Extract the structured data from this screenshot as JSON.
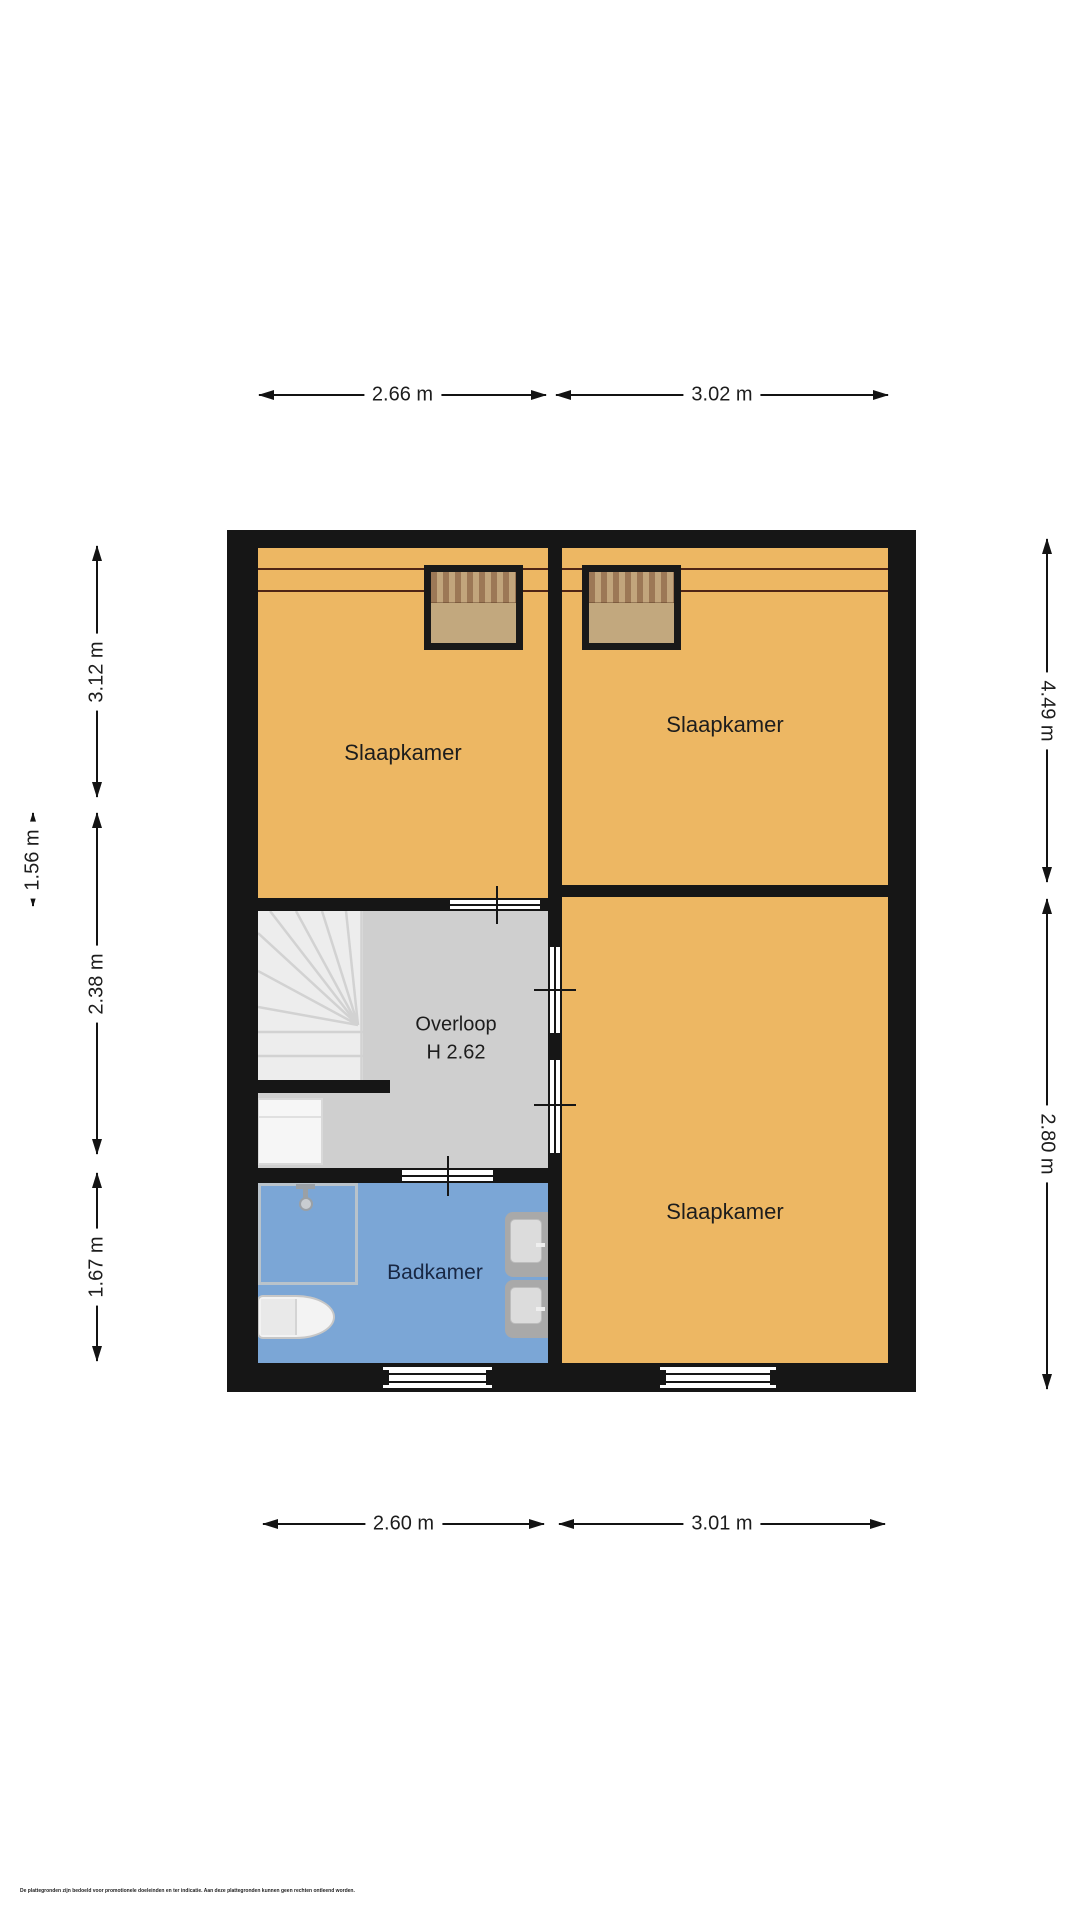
{
  "rooms": {
    "bedroom_top_left": {
      "label": "Slaapkamer"
    },
    "bedroom_right": {
      "label": "Slaapkamer"
    },
    "bedroom_bottom_right": {
      "label": "Slaapkamer"
    },
    "landing": {
      "label": "Overloop",
      "ceiling_height": "H 2.62"
    },
    "bathroom": {
      "label": "Badkamer"
    }
  },
  "dimensions": {
    "top_left": "2.66 m",
    "top_right": "3.02 m",
    "bottom_left": "2.60 m",
    "bottom_right": "3.01 m",
    "left_upper": "3.12 m",
    "left_middle": "2.38 m",
    "left_inner": "1.56 m",
    "left_lower": "1.67 m",
    "right_upper": "4.49 m",
    "right_lower": "2.80 m"
  },
  "footer": {
    "disclaimer": "De plattegronden zijn bedoeld voor promotionele doeleinden en ter indicatie. Aan deze plattegronden kunnen geen rechten ontleend worden."
  },
  "colors": {
    "wall": "#161616",
    "bedroom": "#edb763",
    "bathroom": "#7ba6d6",
    "landing": "#cfcfcf",
    "stairs": "#ededed",
    "roof_tile": "#9c5a3e",
    "glass": "#c2a87e",
    "dimension_line": "#131313",
    "bathroom_label_text": "#182743"
  }
}
